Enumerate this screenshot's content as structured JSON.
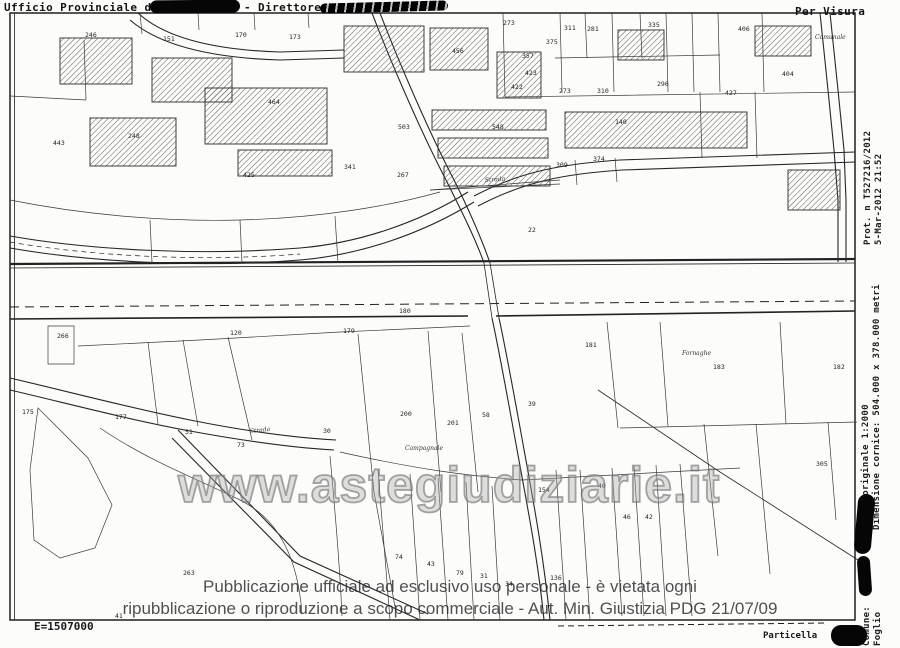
{
  "header": {
    "office_label": "Ufficio Provinciale di",
    "director_label": "- Direttore",
    "visura_label": "Per Visura"
  },
  "right_margin": {
    "protocol": "Prot. n  T527216/2012",
    "datetime": "5-Mar-2012 21:52",
    "scale": "Scala originale 1:2000",
    "frame_size": "Dimensione cornice: 504.000 x 378.000 metri",
    "comune": "Comune:",
    "foglio": "Foglio"
  },
  "footer": {
    "disclaimer_line1": "Pubblicazione ufficiale ad esclusivo uso personale - è vietata ogni",
    "disclaimer_line2": "ripubblicazione o riproduzione a scopo commerciale - Aut. Min. Giustizia PDG 21/07/09",
    "east_coordinate": "E=1507000",
    "particella": "Particella"
  },
  "watermark": {
    "text": "www.astegiudiziarie.it"
  },
  "colors": {
    "ink": "#1e1e1e",
    "paper": "#fcfcfb",
    "watermark_gray": "#9a9a9a",
    "disclaimer_gray": "#2a2a2a"
  },
  "map": {
    "road_label": {
      "x": 399,
      "y": 313,
      "t": "180"
    },
    "parcel_labels": [
      {
        "x": 85,
        "y": 37,
        "t": "246"
      },
      {
        "x": 163,
        "y": 41,
        "t": "151"
      },
      {
        "x": 235,
        "y": 37,
        "t": "170"
      },
      {
        "x": 289,
        "y": 39,
        "t": "173"
      },
      {
        "x": 53,
        "y": 145,
        "t": "443"
      },
      {
        "x": 128,
        "y": 138,
        "t": "248"
      },
      {
        "x": 268,
        "y": 104,
        "t": "464"
      },
      {
        "x": 243,
        "y": 177,
        "t": "425"
      },
      {
        "x": 344,
        "y": 169,
        "t": "341"
      },
      {
        "x": 397,
        "y": 177,
        "t": "267"
      },
      {
        "x": 398,
        "y": 129,
        "t": "503"
      },
      {
        "x": 452,
        "y": 53,
        "t": "456"
      },
      {
        "x": 503,
        "y": 25,
        "t": "273"
      },
      {
        "x": 546,
        "y": 44,
        "t": "375"
      },
      {
        "x": 522,
        "y": 58,
        "t": "357"
      },
      {
        "x": 564,
        "y": 30,
        "t": "311"
      },
      {
        "x": 587,
        "y": 31,
        "t": "281"
      },
      {
        "x": 648,
        "y": 27,
        "t": "335"
      },
      {
        "x": 738,
        "y": 31,
        "t": "406"
      },
      {
        "x": 525,
        "y": 75,
        "t": "423"
      },
      {
        "x": 511,
        "y": 89,
        "t": "422"
      },
      {
        "x": 559,
        "y": 93,
        "t": "273"
      },
      {
        "x": 597,
        "y": 93,
        "t": "310"
      },
      {
        "x": 657,
        "y": 86,
        "t": "296"
      },
      {
        "x": 725,
        "y": 95,
        "t": "427"
      },
      {
        "x": 782,
        "y": 76,
        "t": "404"
      },
      {
        "x": 492,
        "y": 129,
        "t": "548"
      },
      {
        "x": 615,
        "y": 124,
        "t": "140"
      },
      {
        "x": 556,
        "y": 167,
        "t": "309"
      },
      {
        "x": 593,
        "y": 161,
        "t": "374"
      },
      {
        "x": 528,
        "y": 232,
        "t": "22"
      },
      {
        "x": 57,
        "y": 338,
        "t": "266"
      },
      {
        "x": 230,
        "y": 335,
        "t": "120"
      },
      {
        "x": 343,
        "y": 333,
        "t": "179"
      },
      {
        "x": 22,
        "y": 414,
        "t": "175"
      },
      {
        "x": 115,
        "y": 419,
        "t": "177"
      },
      {
        "x": 185,
        "y": 434,
        "t": "51"
      },
      {
        "x": 237,
        "y": 447,
        "t": "73"
      },
      {
        "x": 323,
        "y": 433,
        "t": "30"
      },
      {
        "x": 400,
        "y": 416,
        "t": "200"
      },
      {
        "x": 447,
        "y": 425,
        "t": "201"
      },
      {
        "x": 482,
        "y": 417,
        "t": "58"
      },
      {
        "x": 528,
        "y": 406,
        "t": "39"
      },
      {
        "x": 585,
        "y": 347,
        "t": "181"
      },
      {
        "x": 713,
        "y": 369,
        "t": "183"
      },
      {
        "x": 833,
        "y": 369,
        "t": "182"
      },
      {
        "x": 816,
        "y": 466,
        "t": "305"
      },
      {
        "x": 538,
        "y": 492,
        "t": "154"
      },
      {
        "x": 598,
        "y": 488,
        "t": "40"
      },
      {
        "x": 623,
        "y": 519,
        "t": "46"
      },
      {
        "x": 645,
        "y": 519,
        "t": "42"
      },
      {
        "x": 395,
        "y": 559,
        "t": "74"
      },
      {
        "x": 427,
        "y": 566,
        "t": "43"
      },
      {
        "x": 456,
        "y": 575,
        "t": "79"
      },
      {
        "x": 480,
        "y": 578,
        "t": "31"
      },
      {
        "x": 505,
        "y": 586,
        "t": "34"
      },
      {
        "x": 550,
        "y": 580,
        "t": "136"
      },
      {
        "x": 183,
        "y": 575,
        "t": "263"
      },
      {
        "x": 115,
        "y": 618,
        "t": "41"
      }
    ],
    "street_labels": [
      {
        "x": 485,
        "y": 182,
        "t": "Strada",
        "r": -4
      },
      {
        "x": 250,
        "y": 433,
        "t": "Strada",
        "r": -6
      },
      {
        "x": 405,
        "y": 450,
        "t": "Campagnale",
        "r": 0
      },
      {
        "x": 682,
        "y": 355,
        "t": "Fornaghe",
        "r": 0
      },
      {
        "x": 815,
        "y": 39,
        "t": "Comunale",
        "r": 0
      }
    ]
  }
}
